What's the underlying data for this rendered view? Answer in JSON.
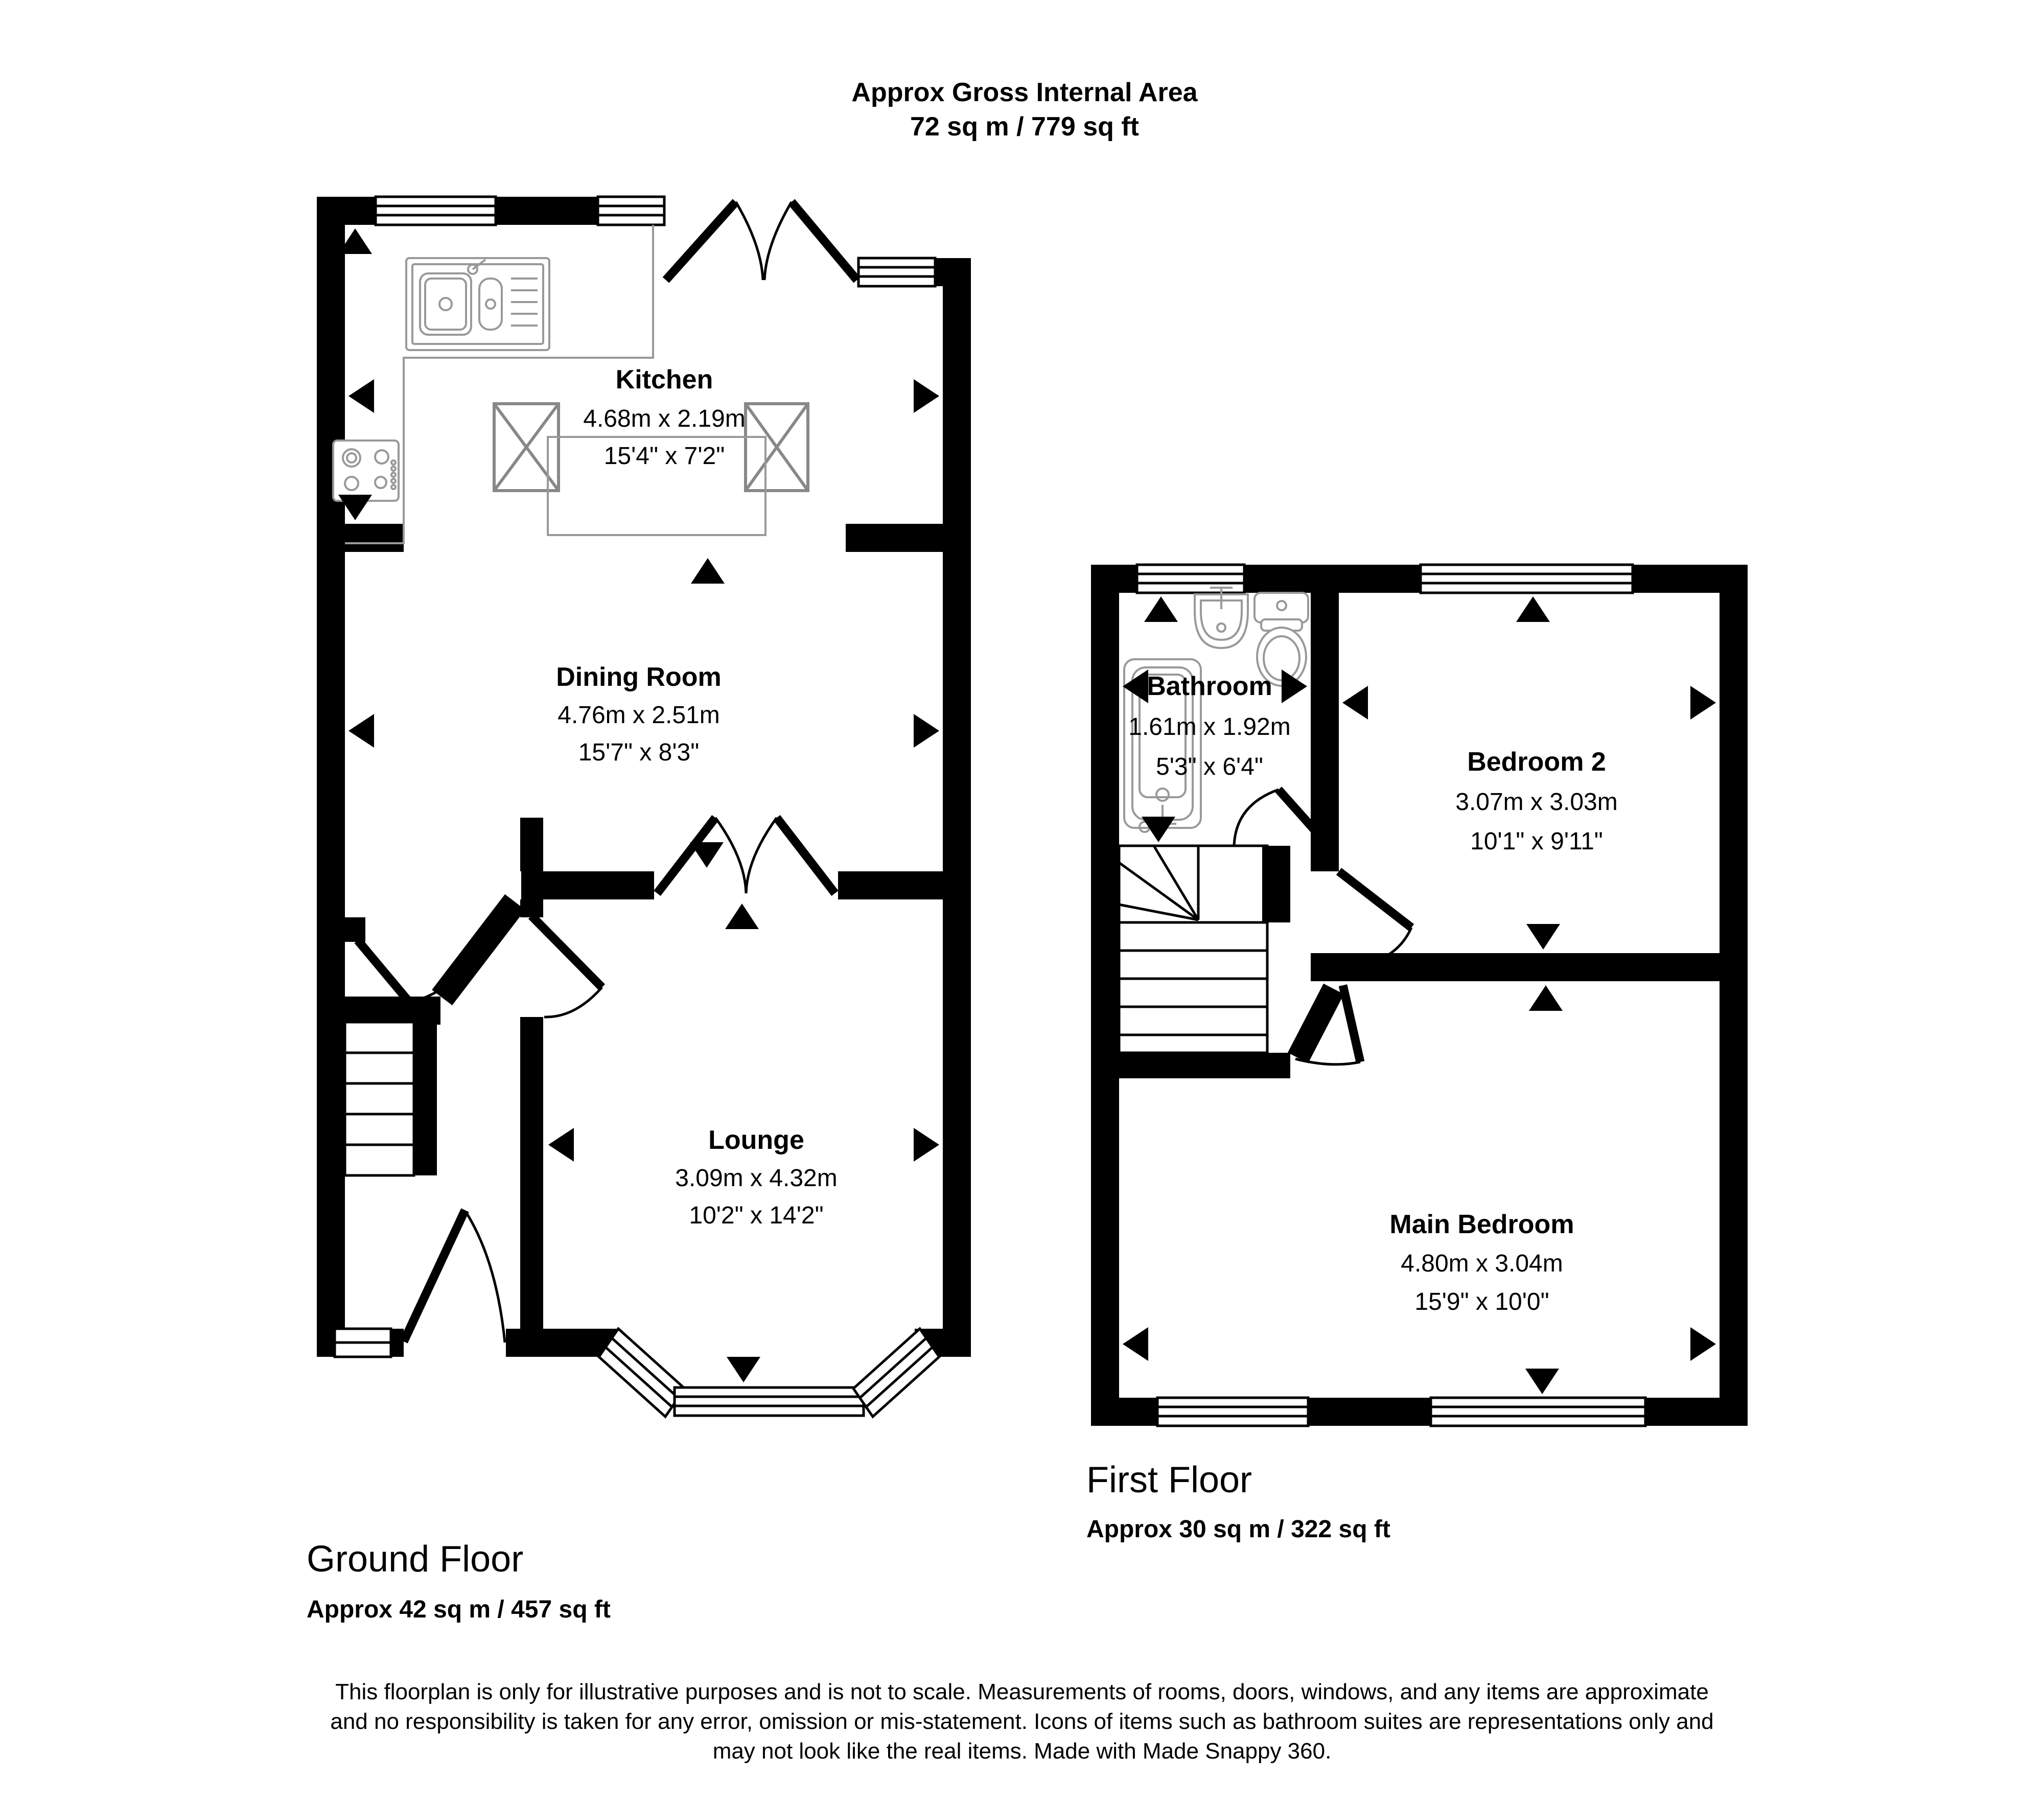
{
  "header": {
    "title": "Approx Gross Internal Area",
    "subtitle": "72 sq m / 779 sq ft"
  },
  "ground_floor": {
    "label": "Ground Floor",
    "area": "Approx 42 sq m / 457 sq ft",
    "rooms": {
      "kitchen": {
        "name": "Kitchen",
        "metric": "4.68m x 2.19m",
        "imperial": "15'4\" x 7'2\""
      },
      "dining": {
        "name": "Dining Room",
        "metric": "4.76m x 2.51m",
        "imperial": "15'7\" x 8'3\""
      },
      "lounge": {
        "name": "Lounge",
        "metric": "3.09m x 4.32m",
        "imperial": "10'2\" x 14'2\""
      }
    }
  },
  "first_floor": {
    "label": "First Floor",
    "area": "Approx 30 sq m / 322 sq ft",
    "rooms": {
      "bathroom": {
        "name": "Bathroom",
        "metric": "1.61m x 1.92m",
        "imperial": "5'3\" x 6'4\""
      },
      "bedroom2": {
        "name": "Bedroom 2",
        "metric": "3.07m x 3.03m",
        "imperial": "10'1\" x 9'11\""
      },
      "main_bedroom": {
        "name": "Main Bedroom",
        "metric": "4.80m x 3.04m",
        "imperial": "15'9\" x 10'0\""
      }
    }
  },
  "disclaimer": {
    "line1": "This floorplan is only for illustrative purposes and is not to scale. Measurements of rooms, doors, windows, and any items are approximate",
    "line2": "and no responsibility is taken for any error, omission or mis-statement. Icons of items such as bathroom suites are representations only and",
    "line3": "may not look like the real items. Made with Made Snappy 360."
  },
  "colors": {
    "wall": "#000000",
    "fixture_outline": "#999999",
    "unit_outline": "#888888",
    "background": "#ffffff"
  }
}
